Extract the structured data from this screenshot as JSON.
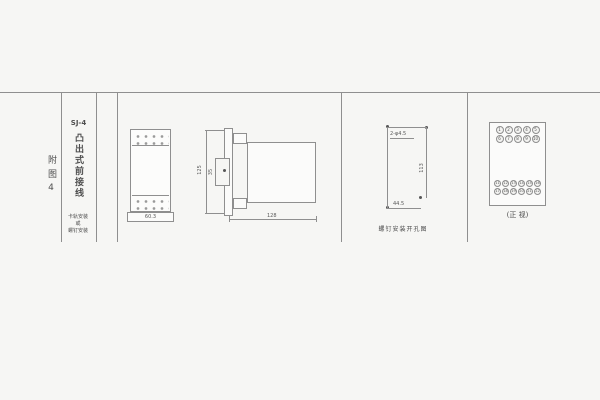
{
  "colors": {
    "background": "#f6f6f4",
    "line": "#8f8f8f",
    "text": "#4f4f4f"
  },
  "table": {
    "col1_label": "附图4",
    "col2": {
      "model": "SJ-4",
      "vertical_title": "凸出式前接线",
      "note_lines": [
        "卡轨安装",
        "或",
        "螺钉安装"
      ]
    }
  },
  "front_view": {
    "width_dim": "60.3"
  },
  "side_view": {
    "height_dim": "125",
    "clip_dim": "35",
    "depth_dim": "128"
  },
  "drill_view": {
    "holes_note": "2-φ4.5",
    "height_dim": "113",
    "width_dim": "44.5",
    "caption": "螺钉安装开孔图"
  },
  "terminal_view": {
    "caption": "(正 视)",
    "top_rows": [
      [
        "1",
        "2",
        "3",
        "4",
        "5"
      ],
      [
        "6",
        "7",
        "8",
        "9",
        "10"
      ]
    ],
    "bottom_rows": [
      [
        "11",
        "12",
        "13",
        "14",
        "15",
        "16"
      ],
      [
        "17",
        "18",
        "19",
        "20",
        "21",
        "22"
      ]
    ]
  }
}
